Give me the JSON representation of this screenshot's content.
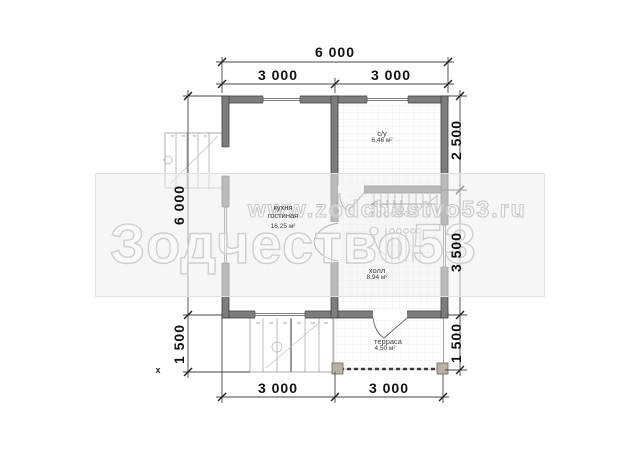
{
  "plan_title": "first-floor-plan",
  "dimensions": {
    "top": {
      "total": "6 000",
      "left": "3 000",
      "right": "3 000"
    },
    "left_side": {
      "height": "6 000",
      "porch": "1 500"
    },
    "right_side": {
      "top": "2 500",
      "middle": "3 500",
      "bottom": "1 500"
    },
    "bottom": {
      "left": "3 000",
      "right": "3 000"
    }
  },
  "rooms": {
    "kitchen": {
      "line1": "кухня",
      "line2": "гостиная",
      "area": "16,25 м²"
    },
    "bathroom": {
      "name": "с/у",
      "area": "6,46 м²"
    },
    "hall": {
      "name": "холл",
      "area": "8,94 м²"
    },
    "terrace": {
      "name": "терраса",
      "area": "4,50 м²"
    }
  },
  "watermark": {
    "url": "www.zodchestvo53.ru",
    "brand": "Зодчество53"
  },
  "marker": "x",
  "colors": {
    "wall_fill": "#7d7d7d",
    "wall_outline": "#3f3f3f",
    "dimension_line": "#333333",
    "tile_line": "#e4e4e4",
    "watermark_stroke": "#cccccc",
    "terrace_post": "#b9b1a2"
  }
}
